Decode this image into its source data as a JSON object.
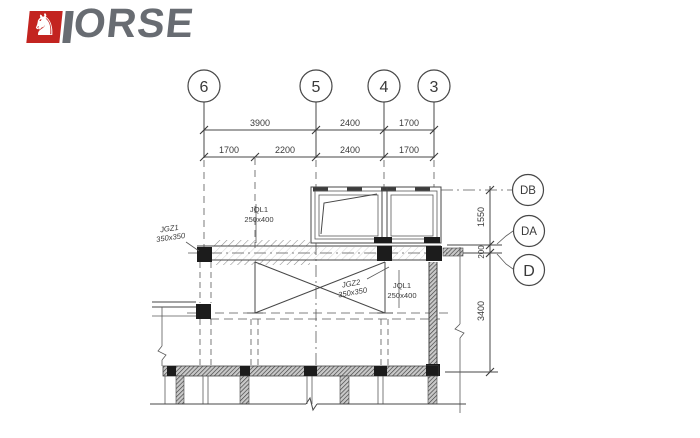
{
  "page": {
    "background": "#ffffff"
  },
  "logo": {
    "brand": "HORSE",
    "brand_visible_letters": "ORSE",
    "red": "#c32420",
    "gray": "#686c72",
    "icon": "horse-knight-icon"
  },
  "drawing": {
    "line_color": "#474747",
    "grid_columns": [
      {
        "label": "6"
      },
      {
        "label": "5"
      },
      {
        "label": "4"
      },
      {
        "label": "3"
      }
    ],
    "grid_rows": [
      {
        "label": "DB"
      },
      {
        "label": "DA"
      },
      {
        "label": "D"
      }
    ],
    "dims_top_row1": [
      "3900",
      "2400",
      "1700"
    ],
    "dims_top_row2": [
      "1700",
      "2200",
      "2400",
      "1700"
    ],
    "dims_right": [
      "1550",
      "200",
      "3400"
    ],
    "members": [
      {
        "name": "JGZ1",
        "size": "350x350"
      },
      {
        "name": "JQL1",
        "size": "250x400"
      },
      {
        "name": "JGZ2",
        "size": "350x350"
      },
      {
        "name": "JQL1",
        "size": "250x400"
      }
    ]
  }
}
